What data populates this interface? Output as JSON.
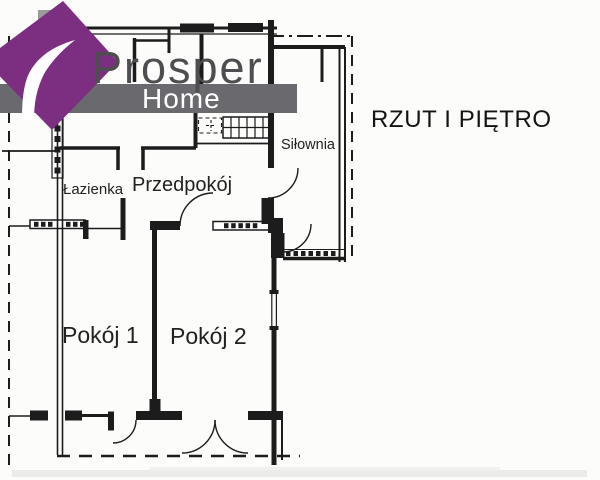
{
  "title": {
    "text": "RZUT I PIĘTRO"
  },
  "logo": {
    "brand": "Prosper",
    "subtitle": "Home"
  },
  "rooms": [
    {
      "id": "lazienka",
      "label": "Łazienka"
    },
    {
      "id": "przedpokoj",
      "label": "Przedpokój"
    },
    {
      "id": "silownia",
      "label": "Siłownia"
    },
    {
      "id": "pokoj-1",
      "label": "Pokój 1"
    },
    {
      "id": "pokoj-2",
      "label": "Pokój 2"
    }
  ],
  "colors": {
    "paper": "#fcfcfa",
    "wall": "#1c1c1c",
    "label_text": "#222222",
    "title_text": "#141414",
    "logo_diamond": "#7c2e81",
    "logo_band": "#6a696e",
    "logo_brand_text": "#4e4e50",
    "logo_subtitle_text": "#ffffff",
    "scan_gray": "#9c9c9a"
  }
}
